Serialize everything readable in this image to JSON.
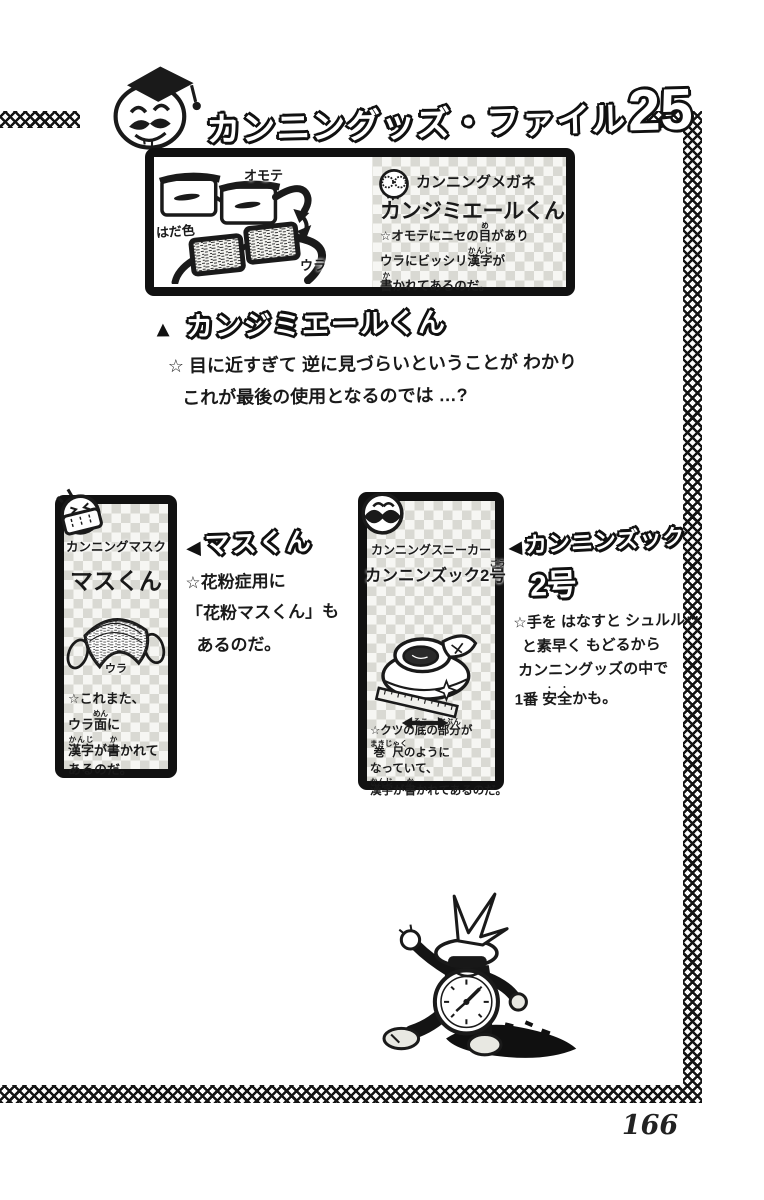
{
  "colors": {
    "ink": "#1a1a1a",
    "paper": "#ffffff",
    "panel_checker": "#d9d9d3"
  },
  "page": {
    "number": "166"
  },
  "header": {
    "title_main": "カンニングッズ・ファイル",
    "title_number": "25",
    "mascot_icon": "professor-face-icon"
  },
  "panel_glasses": {
    "category": "カンニングメガネ",
    "name": "カンジミエールくん",
    "labels": {
      "front": "オモテ",
      "skin": "はだ色",
      "back": "ウラ"
    },
    "description_lines": [
      "☆オモテにニセの目(め)があり",
      "ウラにビッシリ漢字(かんじ)が",
      "書(か)かれてあるのだ。"
    ]
  },
  "section_glasses": {
    "marker": "▲",
    "heading": "カンジミエールくん",
    "comment_lines": [
      "☆ 目に近すぎて 逆に見づらいということが わかり",
      "これが最後の使用となるのでは …?"
    ]
  },
  "panel_mask": {
    "category": "カンニングマスク",
    "name": "マスくん",
    "label_back": "ウラ",
    "description_lines": [
      "☆これまた、",
      "ウラ面(めん)に",
      "漢字(かんじ)が書(か)かれて",
      "あるのだ。"
    ]
  },
  "section_mask": {
    "marker": "◀",
    "heading": "マスくん",
    "comment_lines": [
      "☆花粉症用に",
      "「花粉マスくん」も",
      "あるのだ。"
    ]
  },
  "panel_sneaker": {
    "category": "カンニングスニーカー",
    "name": "カンニンズック2号(ごう)",
    "description_lines": [
      "☆クツの底(そこ)の部分(ぶぶん)が",
      "巻尺(まきじゃく)のように",
      "なっていて、",
      "漢字(かんじ)が書(か)かれてあるのだ。"
    ]
  },
  "section_sneaker": {
    "marker": "◀",
    "heading_line1": "カンニンズック",
    "heading_line2": "2号",
    "comment_lines": [
      "☆手を はなすと シュルルッ",
      "と素早く もどるから",
      "カンニングッズの中で",
      "1番 安全(・・)かも。"
    ]
  }
}
